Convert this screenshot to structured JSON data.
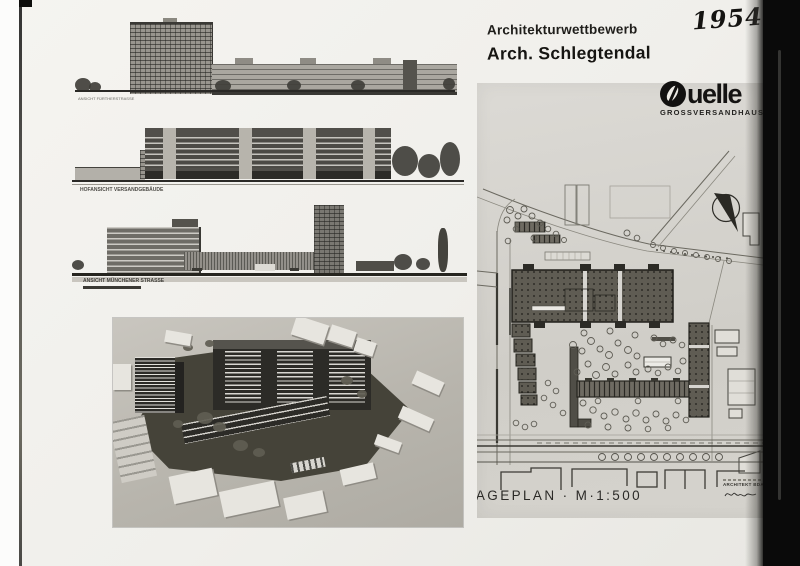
{
  "page": {
    "year": "1954",
    "header": {
      "competition": "Architekturwettbewerb",
      "architect": "Arch. Schlegtendal"
    },
    "logo": {
      "brand": "Quelle",
      "brand_tail": "uelle",
      "subtitle": "GROSSVERSANDHAUS"
    },
    "elevations": [
      {
        "caption": "ANSICHT FÜRTHERSTRASSE"
      },
      {
        "caption": "HOFANSICHT VERSANDGEBÄUDE"
      },
      {
        "caption": "ANSICHT MÜNCHENER STRASSE"
      }
    ],
    "plan": {
      "caption": "LAGEPLAN · M·1:500",
      "stamp": "ARCHITEKT BDA"
    }
  }
}
